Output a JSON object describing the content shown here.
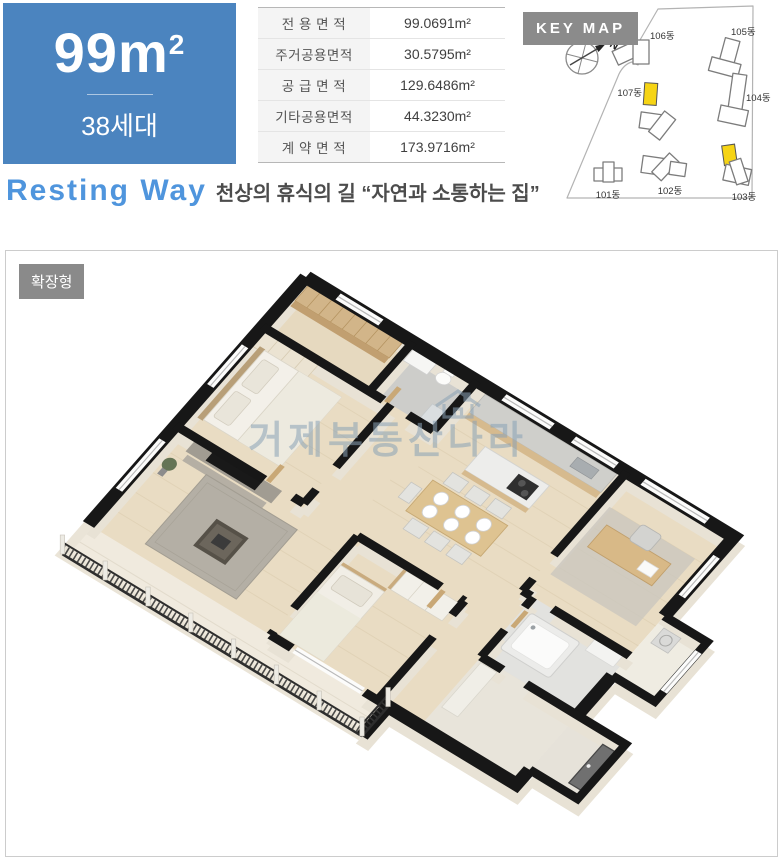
{
  "unit": {
    "size": "99m",
    "size_sup": "2",
    "households": "38세대"
  },
  "areas": {
    "rows": [
      {
        "label": "전 용 면 적",
        "value": "99.0691m²"
      },
      {
        "label": "주거공용면적",
        "value": "30.5795m²"
      },
      {
        "label": "공 급 면 적",
        "value": "129.6486m²"
      },
      {
        "label": "기타공용면적",
        "value": "44.3230m²"
      },
      {
        "label": "계 약 면 적",
        "value": "173.9716m²"
      }
    ]
  },
  "keymap": {
    "title": "KEY MAP",
    "north": "N",
    "highlight_color": "#f6d414",
    "buildings": [
      {
        "label": "101동"
      },
      {
        "label": "102동"
      },
      {
        "label": "103동"
      },
      {
        "label": "104동"
      },
      {
        "label": "105동"
      },
      {
        "label": "106동"
      },
      {
        "label": "107동"
      }
    ]
  },
  "tagline": {
    "en": "Resting Way",
    "ko": "천상의 휴식의 길 “자연과 소통하는 집”"
  },
  "plan": {
    "badge": "확장형",
    "watermark": "거제부동산나라"
  },
  "colors": {
    "accent_blue": "#4b84bf",
    "badge_gray": "#8a8a8a"
  }
}
